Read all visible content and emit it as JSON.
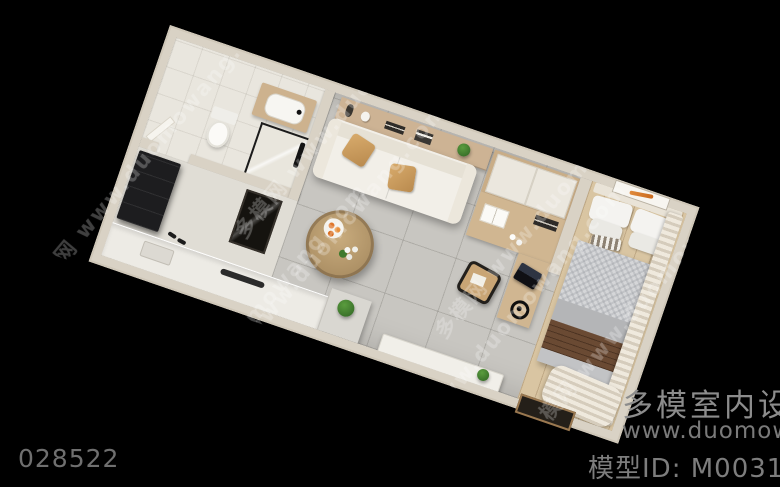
{
  "scene": {
    "description": "Bird's-eye 3D render of a furnished studio apartment floor plan on a black background",
    "rooms": [
      "bathroom",
      "entry",
      "kitchen",
      "living-area",
      "work-area",
      "bedroom"
    ]
  },
  "watermark": {
    "tile_text": "多模网 www.duomowang.com"
  },
  "footer": {
    "image_id": "028522",
    "brand_name": "多模室内设计",
    "brand_url": "www.duomowang",
    "model_id": "模型ID: M0031383"
  },
  "colors": {
    "background": "#000000",
    "wall": "#d9d2c5",
    "tile_floor": "#c8c6c1",
    "wood_floor": "#d9c5a2",
    "bathroom_floor": "#e9e6de",
    "sofa": "#f2efe8",
    "pillow_tan": "#cb9c60",
    "dresser_black": "#1d1d1f",
    "throw_brown": "#6a4a33",
    "plant_green": "#3f7a2e",
    "footer_text": "#7d7d7d"
  }
}
